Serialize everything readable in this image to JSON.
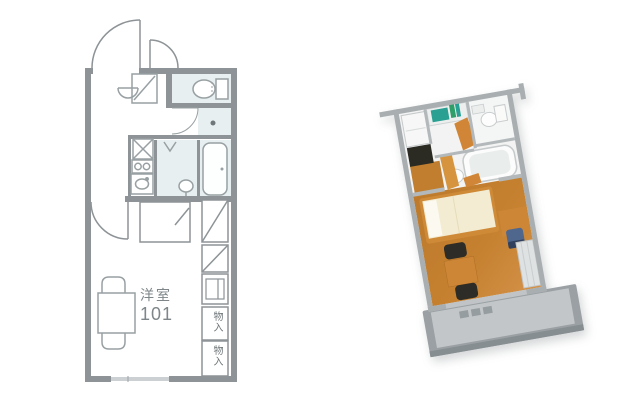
{
  "figure": {
    "left_view": "2d-floor-plan",
    "right_view": "3d-isometric-render"
  },
  "labels": {
    "room_name": "洋室",
    "room_number": "101",
    "storage_top": "物入",
    "storage_bottom": "物入"
  },
  "colors_2d": {
    "wall": "#8d9396",
    "fixture_line": "#98a0a3",
    "wet_area_fill": "#e7eff0",
    "label_text": "#7e8689"
  },
  "colors_3d": {
    "wall_top": "#a9aeb1",
    "wood_floor": "#c5812f",
    "wood_floor_light": "#d4924a",
    "genkan_dark": "#2b2a23",
    "kitchen_teal": "#29a092",
    "bed_mattress": "#f3ecd2",
    "bed_frame": "#cf8a38",
    "furniture_orange": "#cd8636",
    "chair_dark": "#2d2c26",
    "desk_chair_blue": "#4f678d",
    "balcony_slab": "#9aa0a3",
    "balcony_floor": "#c2c6c8"
  }
}
